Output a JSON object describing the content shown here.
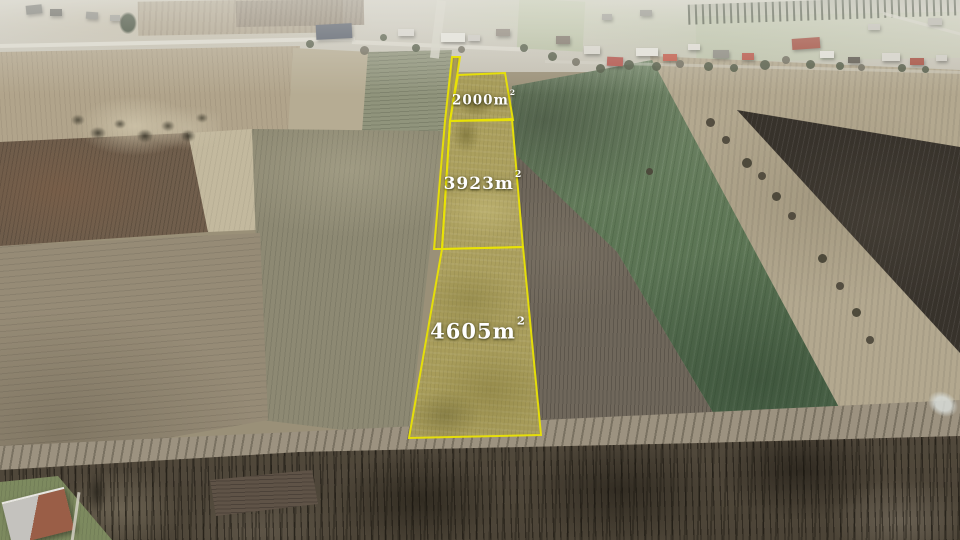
{
  "annotations": {
    "outline_color": "#e9e304",
    "fill_tint": "#aba05c",
    "label_color": "#ffffff",
    "parcels": [
      {
        "area": "2000",
        "unit": "m",
        "exponent": "2"
      },
      {
        "area": "3923",
        "unit": "m",
        "exponent": "2"
      },
      {
        "area": "4605",
        "unit": "m",
        "exponent": "2"
      }
    ]
  }
}
